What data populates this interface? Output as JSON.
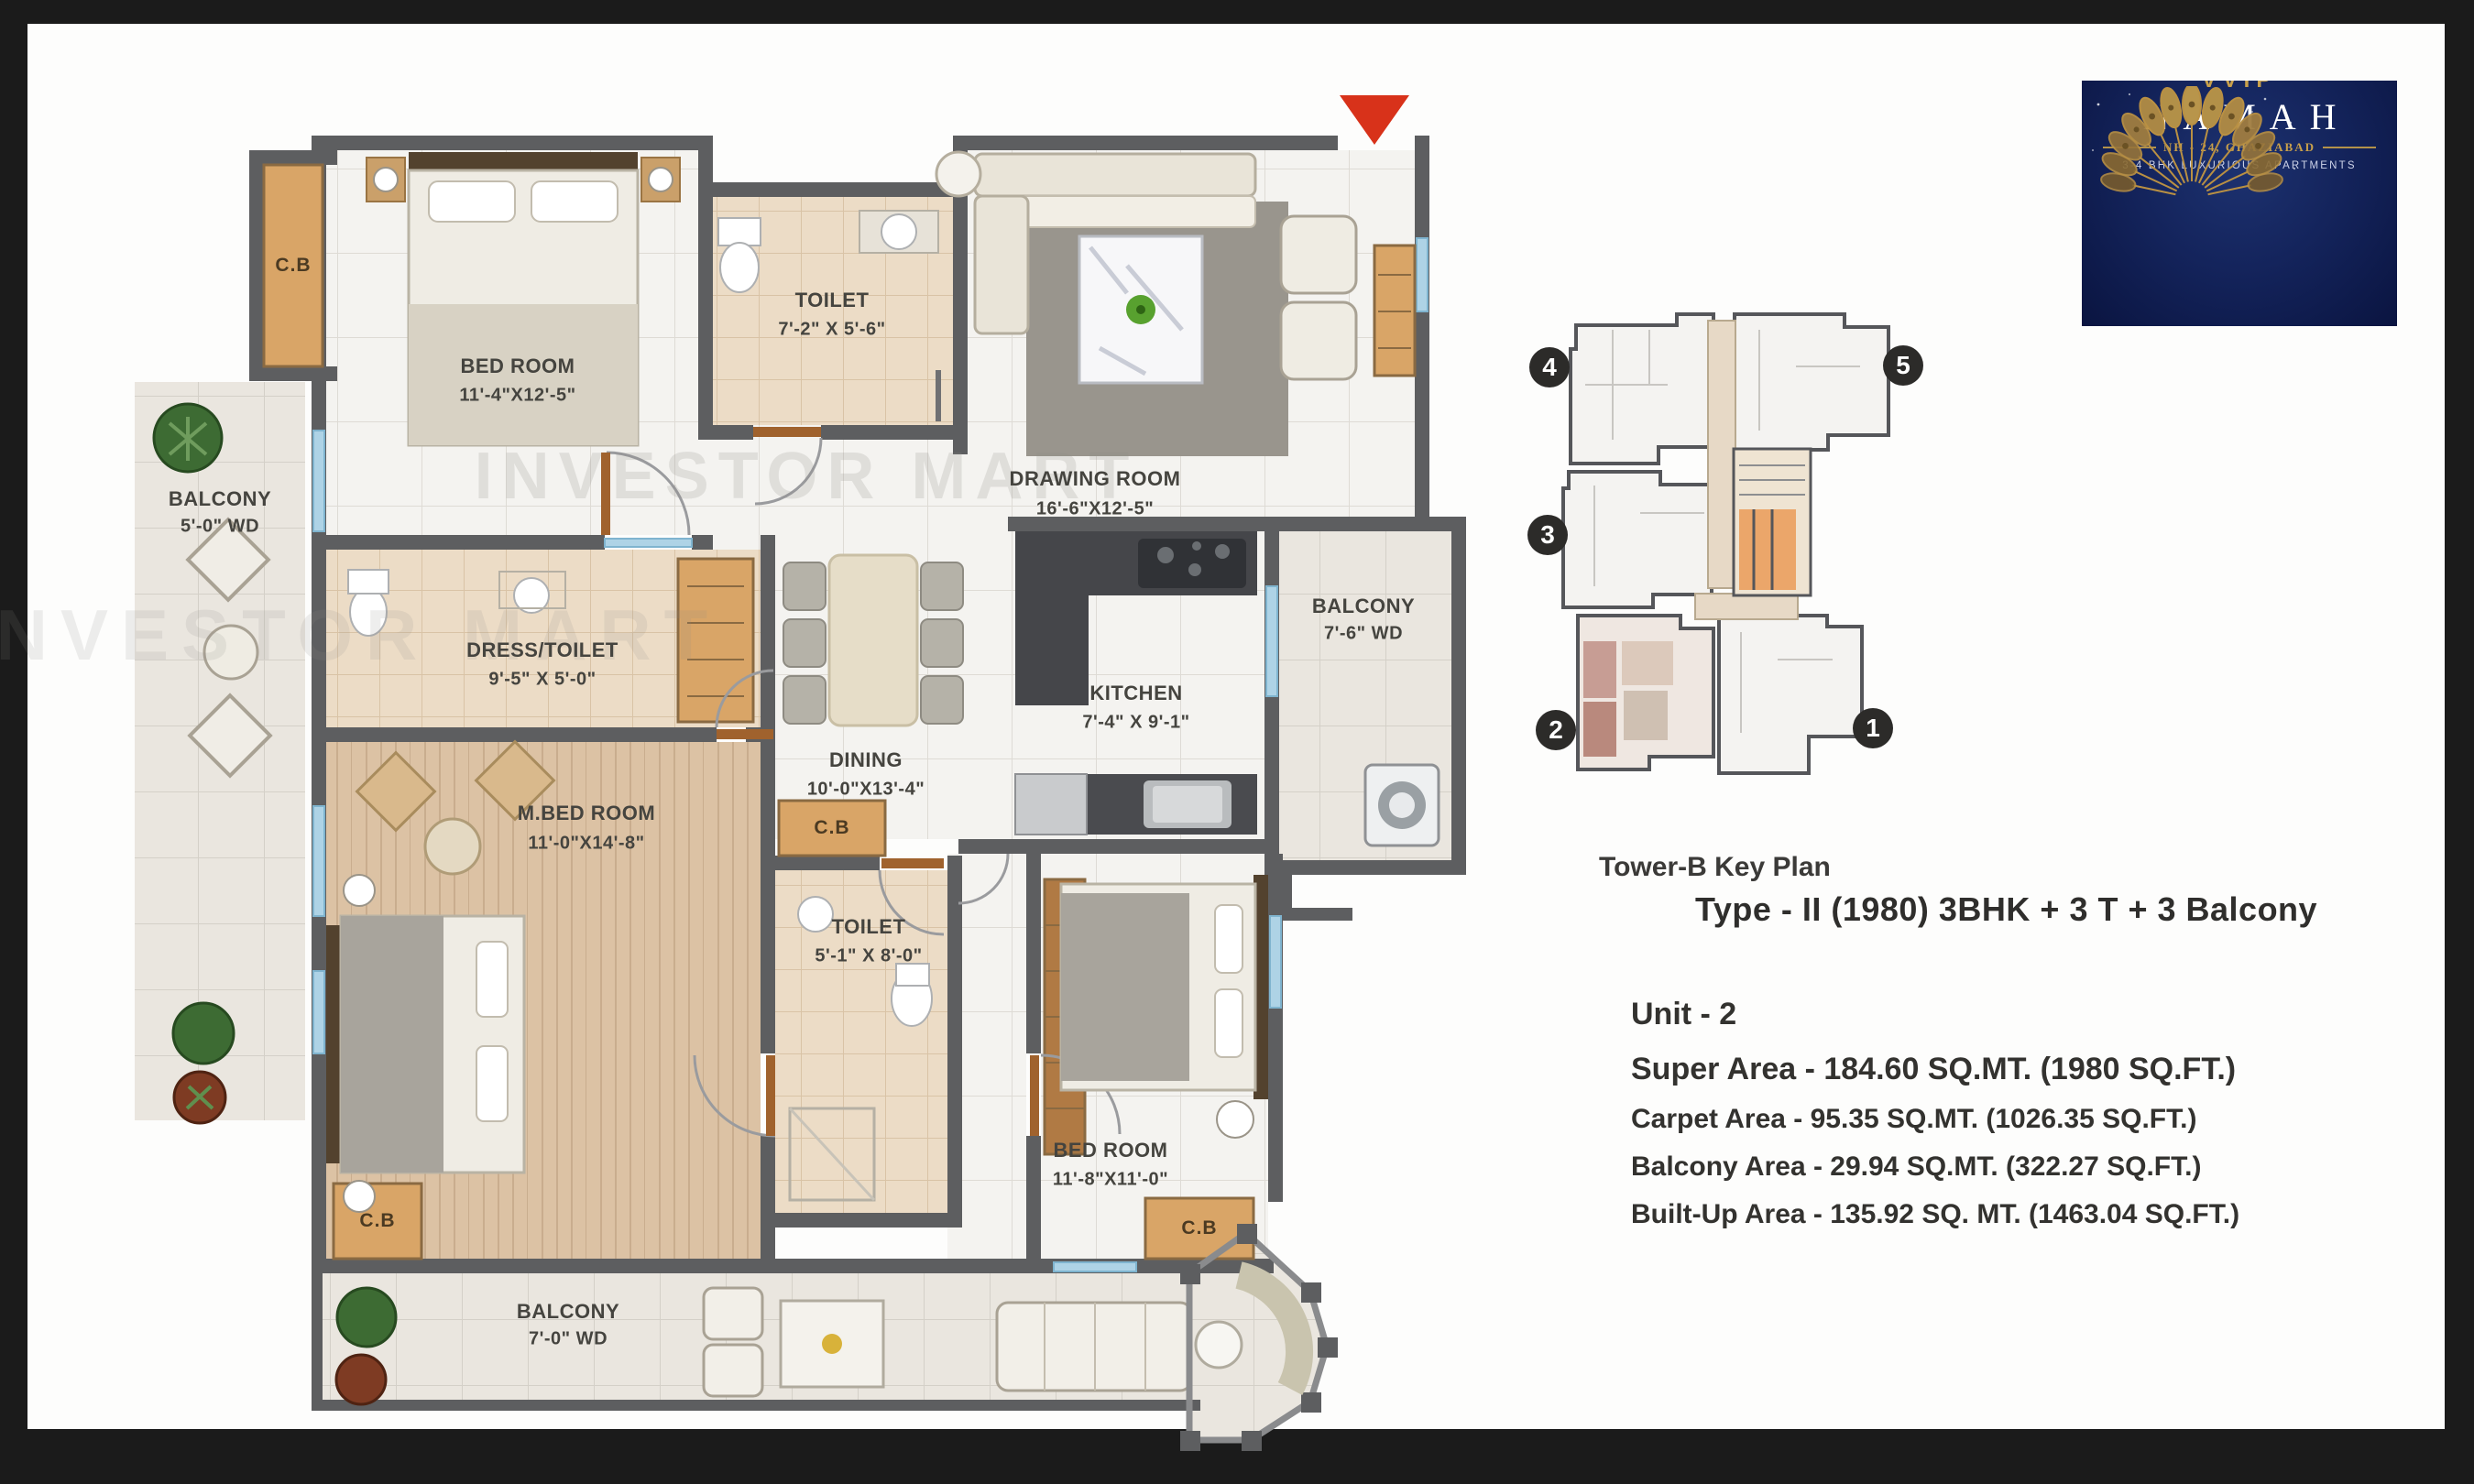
{
  "floor_plan": {
    "watermark": "INVESTOR MART",
    "rooms": [
      {
        "name": "BED ROOM",
        "dims": "11'-4\"X12'-5\""
      },
      {
        "name": "TOILET",
        "dims": "7'-2\" X 5'-6\""
      },
      {
        "name": "DRAWING ROOM",
        "dims": "16'-6\"X12'-5\""
      },
      {
        "name": "BALCONY",
        "dims": "5'-0\" WD"
      },
      {
        "name": "DRESS/TOILET",
        "dims": "9'-5\" X 5'-0\""
      },
      {
        "name": "DINING",
        "dims": "10'-0\"X13'-4\""
      },
      {
        "name": "KITCHEN",
        "dims": "7'-4\" X 9'-1\""
      },
      {
        "name": "BALCONY",
        "dims": "7'-6\" WD"
      },
      {
        "name": "M.BED ROOM",
        "dims": "11'-0\"X14'-8\""
      },
      {
        "name": "TOILET",
        "dims": "5'-1\" X 8'-0\""
      },
      {
        "name": "BED ROOM",
        "dims": "11'-8\"X11'-0\""
      },
      {
        "name": "BALCONY",
        "dims": "7'-0\" WD"
      }
    ],
    "closets": [
      "C.B",
      "C.B",
      "C.B",
      "C.B"
    ]
  },
  "key_plan": {
    "title": "Tower-B Key Plan",
    "type_line": "Type - II (1980) 3BHK + 3 T + 3 Balcony",
    "unit_numbers": [
      "4",
      "5",
      "3",
      "2",
      "1"
    ]
  },
  "details": {
    "unit": "Unit - 2",
    "super_area": "Super Area - 184.60 SQ.MT. (1980 SQ.FT.)",
    "carpet_area": "Carpet Area - 95.35 SQ.MT. (1026.35 SQ.FT.)",
    "balcony_area": "Balcony Area - 29.94 SQ.MT. (322.27 SQ.FT.)",
    "built_up_area": "Built-Up Area - 135.92 SQ. MT. (1463.04 SQ.FT.)"
  },
  "logo": {
    "brand_small": "VVIP",
    "brand_large": "NAMAH",
    "location": "NH - 24, GHAZIABAD",
    "tagline": "3-4 BHK LUXURIOUS APARTMENTS"
  },
  "colors": {
    "wall": "#5d5e60",
    "closet_tan": "#d9a567",
    "entrance_red": "#d8321a",
    "logo_navy": "#14245c",
    "logo_gold": "#c8a04b"
  }
}
